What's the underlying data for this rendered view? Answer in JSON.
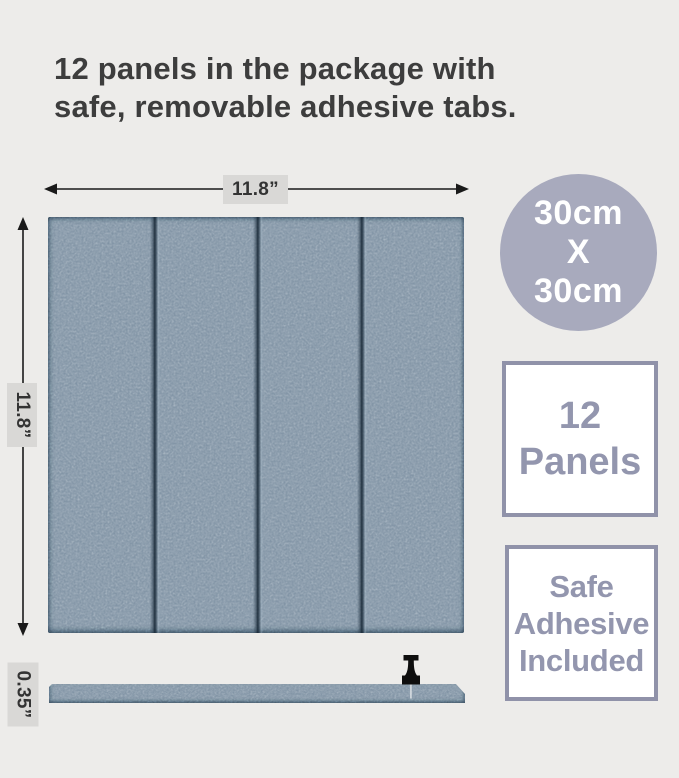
{
  "infographic": {
    "title": {
      "line1": "12 panels in the package with",
      "line2": "safe, removable adhesive tabs."
    },
    "dimensions": {
      "width_label": "11.8”",
      "height_label": "11.8”",
      "thickness_label": "0.35”"
    },
    "badges": {
      "size_circle": {
        "line1": "30cm",
        "line2": "X",
        "line3": "30cm"
      },
      "count_box": {
        "line1": "12",
        "line2": "Panels"
      },
      "adhesive_box": {
        "line1": "Safe",
        "line2": "Adhesive",
        "line3": "Included"
      }
    },
    "colors": {
      "background": "#edecea",
      "title_text": "#3d3d3d",
      "panel_felt": "#7e91a3",
      "panel_groove": "#17242f",
      "circle_badge_bg": "#a8aabd",
      "circle_badge_text": "#ffffff",
      "square_badge_border": "#9092a9",
      "square_badge_text": "#9396ae",
      "dim_label_bg": "#d9d8d6",
      "dim_label_text": "#333333",
      "arrow": "#1a1a1a",
      "pin": "#0e0e0e"
    }
  }
}
